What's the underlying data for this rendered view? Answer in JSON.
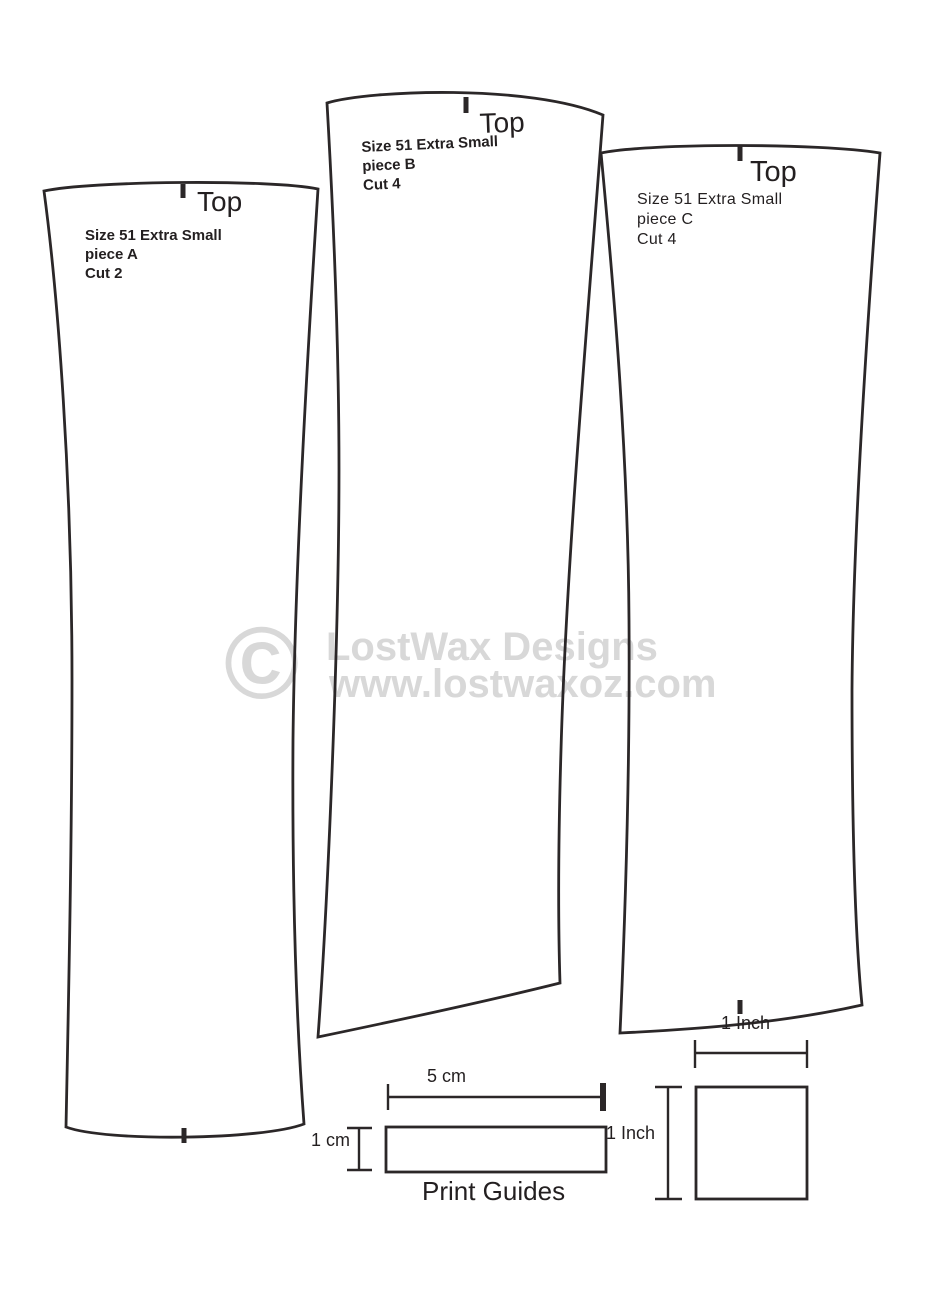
{
  "colors": {
    "line": "#2b2728",
    "text": "#231f20",
    "watermark": "#d8d8d8"
  },
  "pieces": [
    {
      "id": "A",
      "top_label": "Top",
      "size_line": "Size 51 Extra Small",
      "piece_line": "piece A",
      "cut_line": "Cut 2"
    },
    {
      "id": "B",
      "top_label": "Top",
      "size_line": "Size 51 Extra Small",
      "piece_line": "piece B",
      "cut_line": "Cut 4"
    },
    {
      "id": "C",
      "top_label": "Top",
      "size_line": "Size 51 Extra Small",
      "piece_line": "piece C",
      "cut_line": "Cut 4"
    }
  ],
  "watermark": {
    "copyright": "©",
    "line1": "LostWax Designs",
    "line2": "www.lostwaxoz.com"
  },
  "print_guides": {
    "title": "Print Guides",
    "label_5cm": "5 cm",
    "label_1cm": "1 cm",
    "label_1inch_width": "1 Inch",
    "label_1inch_height": "1 Inch",
    "label_1inch_bottom": "1 Inch"
  }
}
